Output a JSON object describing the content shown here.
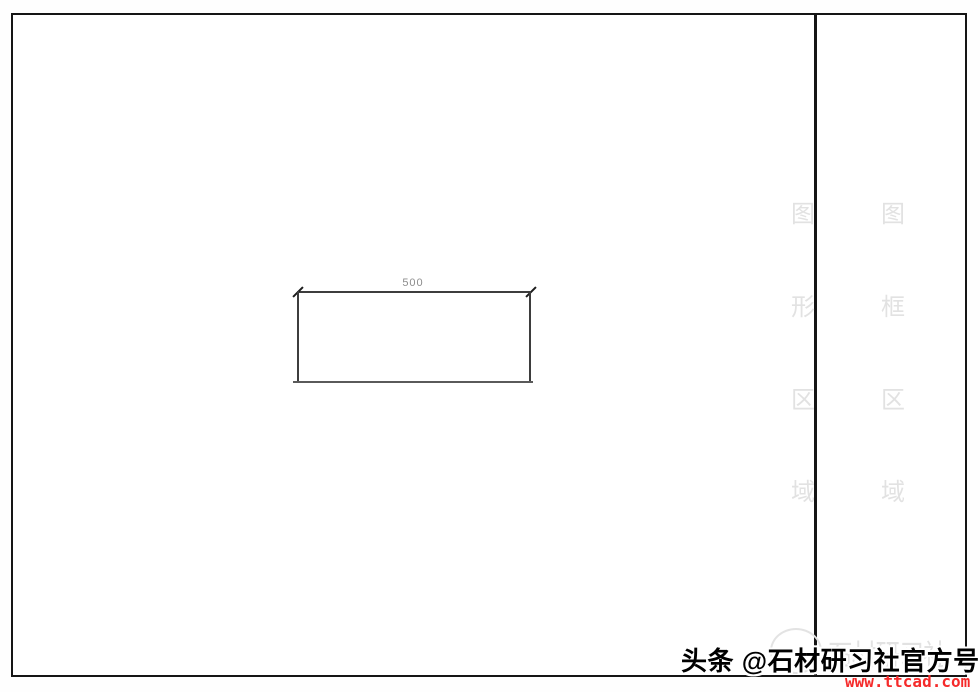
{
  "drawing": {
    "dimension_label": "500"
  },
  "watermarks": {
    "graphics_area_label": [
      "图",
      "形",
      "区",
      "域"
    ],
    "frame_area_label": [
      "图",
      "框",
      "区",
      "域"
    ],
    "stamp_text": "石材研习社"
  },
  "footer": {
    "byline": "头条 @石材研习社官方号",
    "url": "www.ttcad.com"
  },
  "colors": {
    "frame_border": "#151515",
    "dimension_line": "#3d3d3d",
    "dimension_text": "#8d8d8d",
    "watermark_gray": "#e2e2e2",
    "url_red": "#f52a2a"
  }
}
